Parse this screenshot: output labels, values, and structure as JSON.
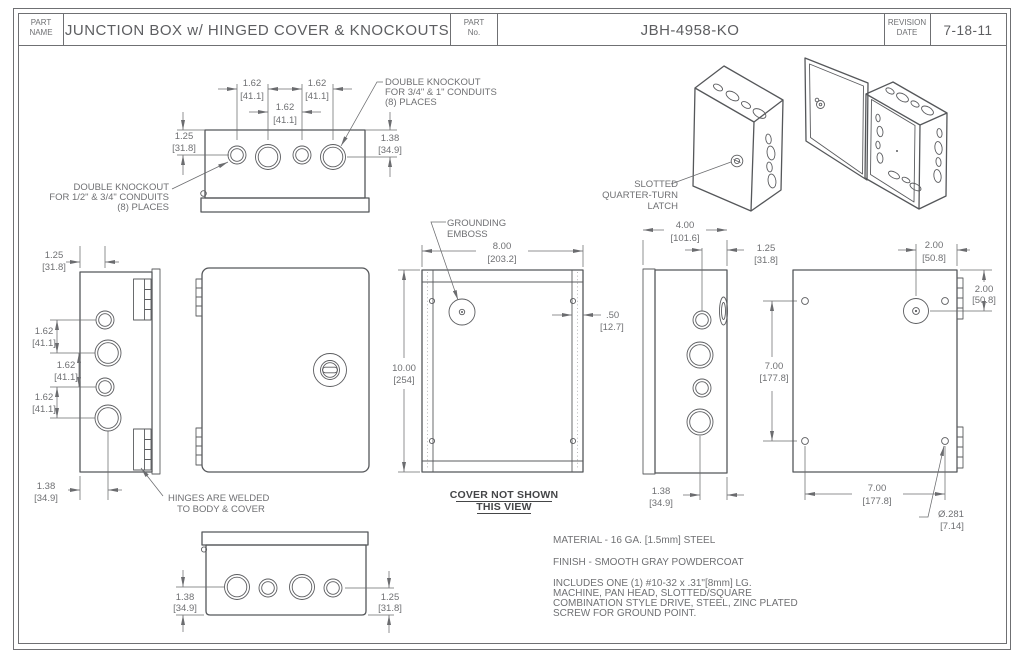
{
  "title_block": {
    "part_name_label_line1": "PART",
    "part_name_label_line2": "NAME",
    "part_name": "JUNCTION BOX w/ HINGED COVER & KNOCKOUTS",
    "part_no_label_line1": "PART",
    "part_no_label_line2": "No.",
    "part_no": "JBH-4958-KO",
    "revision_label_line1": "REVISION",
    "revision_label_line2": "DATE",
    "revision_date": "7-18-11"
  },
  "dims": {
    "d162": {
      "in": "1.62",
      "mm": "[41.1]"
    },
    "d125": {
      "in": "1.25",
      "mm": "[31.8]"
    },
    "d138": {
      "in": "1.38",
      "mm": "[34.9]"
    },
    "d400": {
      "in": "4.00",
      "mm": "[101.6]"
    },
    "d800": {
      "in": "8.00",
      "mm": "[203.2]"
    },
    "d1000": {
      "in": "10.00",
      "mm": "[254]"
    },
    "d050": {
      "in": ".50",
      "mm": "[12.7]"
    },
    "d700": {
      "in": "7.00",
      "mm": "[177.8]"
    },
    "d200": {
      "in": "2.00",
      "mm": "[50.8]"
    },
    "d281": {
      "in": "Ø.281",
      "mm": "[7.14]"
    }
  },
  "callouts": {
    "knockout_large": {
      "l1": "DOUBLE KNOCKOUT",
      "l2": "FOR 3/4\" & 1\" CONDUITS",
      "l3": "(8) PLACES"
    },
    "knockout_small": {
      "l1": "DOUBLE KNOCKOUT",
      "l2": "FOR 1/2\" & 3/4\" CONDUITS",
      "l3": "(8) PLACES"
    },
    "grounding": {
      "l1": "GROUNDING",
      "l2": "EMBOSS"
    },
    "latch": {
      "l1": "SLOTTED",
      "l2": "QUARTER-TURN",
      "l3": "LATCH"
    },
    "hinges": {
      "l1": "HINGES ARE WELDED",
      "l2": "TO BODY & COVER"
    },
    "cover_note": {
      "l1": "COVER NOT SHOWN",
      "l2": "THIS VIEW"
    }
  },
  "notes": {
    "material": "MATERIAL - 16 GA. [1.5mm] STEEL",
    "finish": "FINISH - SMOOTH GRAY POWDERCOAT",
    "includes_l1": "INCLUDES ONE (1) #10-32 x .31\"[8mm] LG.",
    "includes_l2": "MACHINE, PAN HEAD, SLOTTED/SQUARE",
    "includes_l3": "COMBINATION STYLE DRIVE, STEEL, ZINC PLATED",
    "includes_l4": "SCREW FOR GROUND POINT."
  },
  "colors": {
    "line": "#55575a",
    "dim_line": "#6b6c6f",
    "text": "#6f7073",
    "bold_text": "#454648",
    "background": "#ffffff"
  }
}
